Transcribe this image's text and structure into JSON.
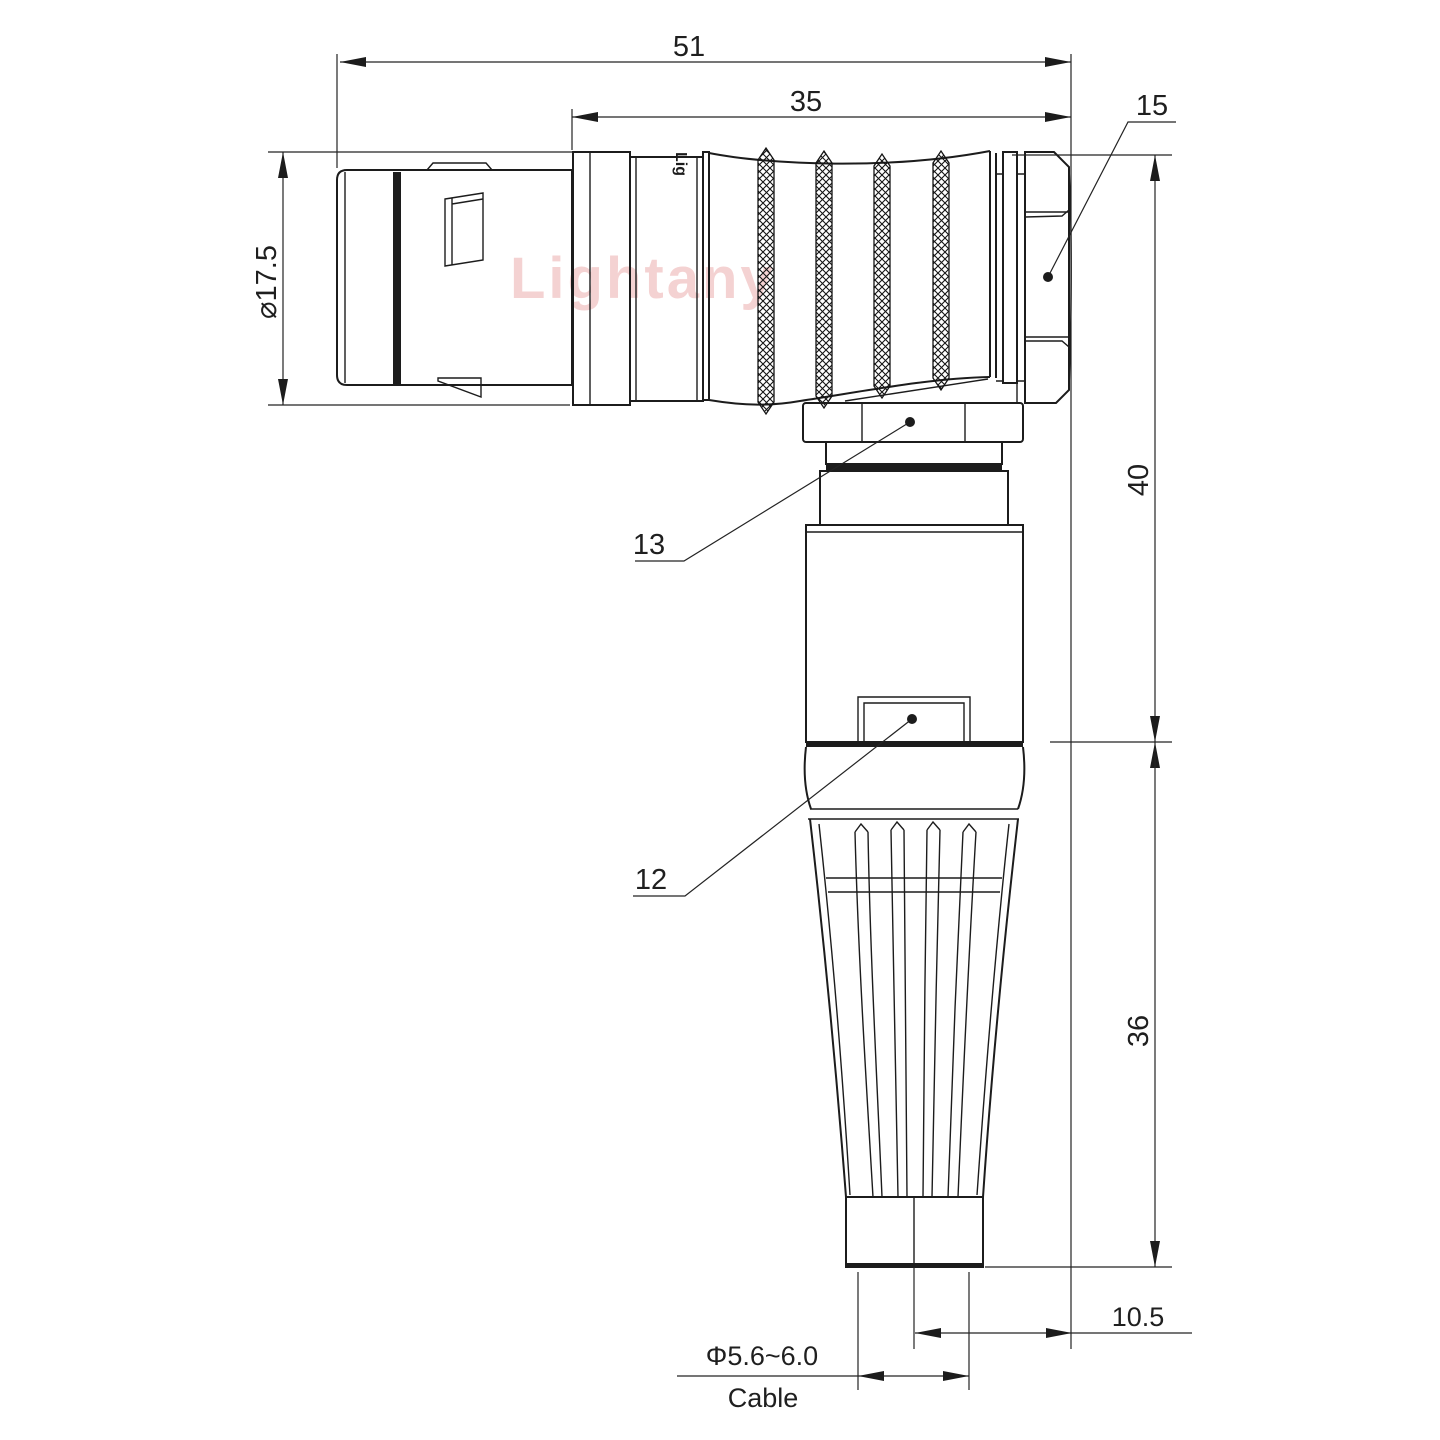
{
  "page": {
    "background": "#ffffff"
  },
  "drawing": {
    "watermark": "Lightany",
    "engraving": "Lig",
    "line_color": "#1c1c1c",
    "watermark_color": "#e89c9c",
    "dimensions": {
      "overall_length": "51",
      "rear_length": "35",
      "coupling_diameter": "⌀17.5",
      "height_upper": "40",
      "height_lower": "36",
      "cable_offset": "10.5",
      "cable_diameter": "Φ5.6~6.0",
      "cable_label": "Cable"
    },
    "part_labels": {
      "backnut": "15",
      "collar": "13",
      "latch": "12"
    }
  }
}
